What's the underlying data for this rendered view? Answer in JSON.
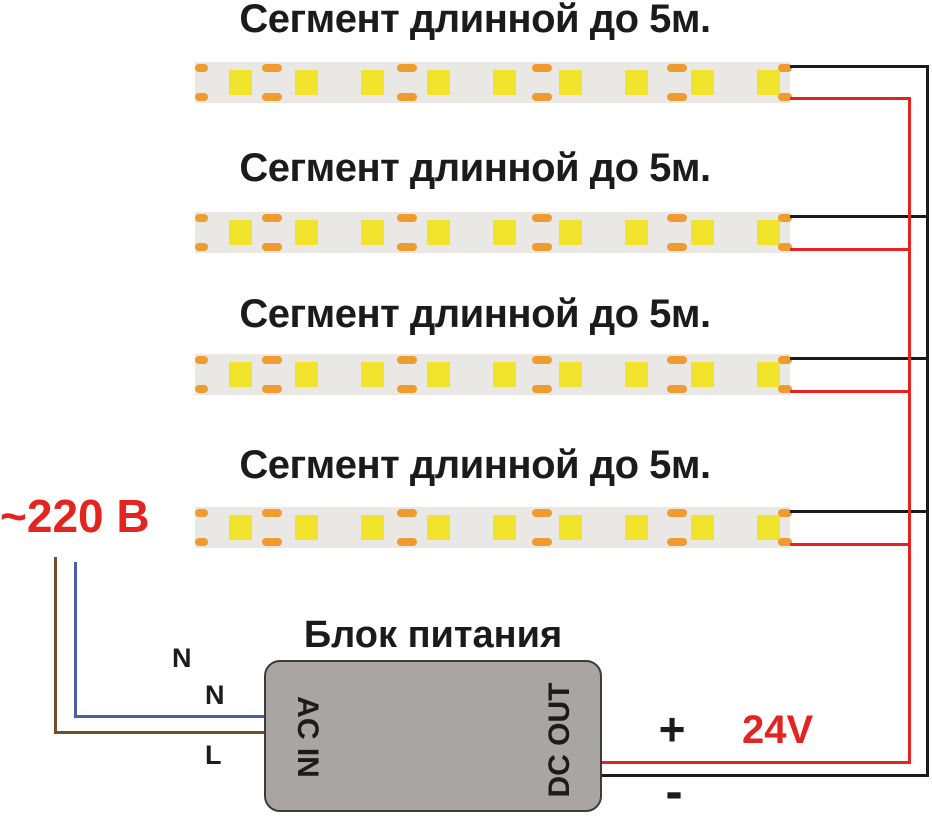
{
  "segments": [
    {
      "label": "Сегмент длинной до 5м."
    },
    {
      "label": "Сегмент длинной до 5м."
    },
    {
      "label": "Сегмент длинной до 5м."
    },
    {
      "label": "Сегмент длинной до 5м."
    }
  ],
  "power_supply": {
    "title": "Блок питания",
    "ac_in_label": "AC IN",
    "dc_out_label": "DC OUT"
  },
  "input": {
    "voltage_label": "~220 В",
    "neutral_label_outer": "N",
    "neutral_label_inner": "N",
    "line_label": "L"
  },
  "output": {
    "voltage_label": "24V",
    "plus_label": "+",
    "minus_label": "-"
  },
  "colors": {
    "text_black": "#1b1b1b",
    "text_red": "#e32421",
    "wire_black": "#1b1b1b",
    "wire_red": "#e8231f",
    "wire_blue": "#4a5fa9",
    "wire_brown": "#744d2c",
    "strip_bg": "#e9e8e4",
    "led_yellow": "#f2e42c",
    "pad_orange": "#f09b2f",
    "psu_fill": "#a8a5a2",
    "psu_border": "#3d3b39"
  }
}
